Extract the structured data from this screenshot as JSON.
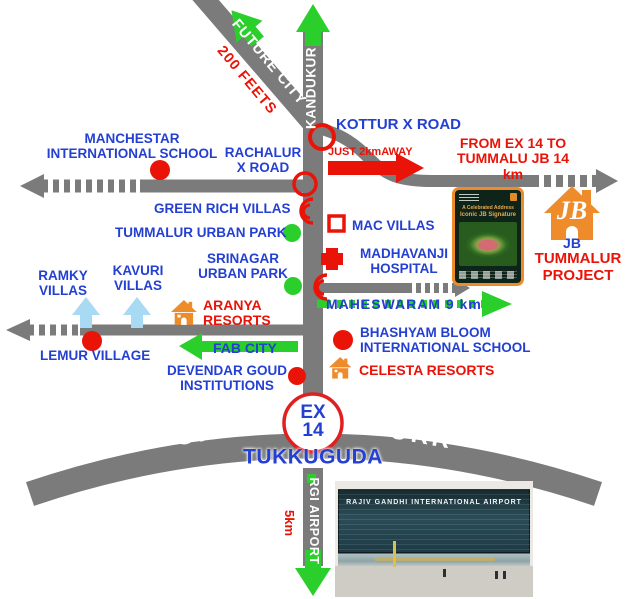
{
  "colors": {
    "road_gray": "#7b7b7b",
    "label_blue": "#2440d2",
    "accent_red": "#ea1308",
    "arrow_green": "#2bcf2b",
    "arrow_light_blue": "#a8daf3",
    "project_orange": "#ee8c2c"
  },
  "roads": {
    "future_city": "FUTURE CITY",
    "two_hundred_feets": "200 FEETS",
    "kandukur": "KANDUKUR",
    "orr": "ORR",
    "rgi_airport": "RGI AIRPORT",
    "airport_distance": "5km"
  },
  "labels": {
    "manchestar": "MANCHESTAR\nINTERNATIONAL SCHOOL",
    "rachalur": "RACHALUR\nX ROAD",
    "kottur": "KOTTUR X ROAD",
    "just_2km": "JUST 2kmAWAY",
    "from_ex14": "FROM EX 14 TO\nTUMMALU JB 14 km",
    "green_rich": "GREEN RICH VILLAS",
    "tummalur_urban_park": "TUMMALUR URBAN PARK",
    "srinagar_urban_park": "SRINAGAR\nURBAN PARK",
    "mac_villas": "MAC VILLAS",
    "madhavanji_hospital": "MADHAVANJI\nHOSPITAL",
    "maheswaram": "MAHESWARAM 9 km",
    "ramky_villas": "RAMKY\nVILLAS",
    "kavuri_villas": "KAVURI\nVILLAS",
    "aranya_resorts": "ARANYA\nRESORTS",
    "lemur_village": "LEMUR VILLAGE",
    "fab_city": "FAB CITY",
    "devendar": "DEVENDAR GOUD\nINSTITUTIONS",
    "bhashyam": "BHASHYAM BLOOM\nINTERNATIONAL SCHOOL",
    "celesta_resorts": "CELESTA RESORTS",
    "jb": "JB",
    "tummalur_project": "TUMMALUR\nPROJECT",
    "ex14": "EX\n14",
    "tukkuguda": "TUKKUGUDA"
  },
  "project": {
    "monogram": "JB",
    "poster_line1": "A Celebrated Address",
    "poster_line2": "Iconic JB Signature"
  },
  "airport_photo": {
    "sign": "RAJIV GANDHI INTERNATIONAL AIRPORT"
  }
}
